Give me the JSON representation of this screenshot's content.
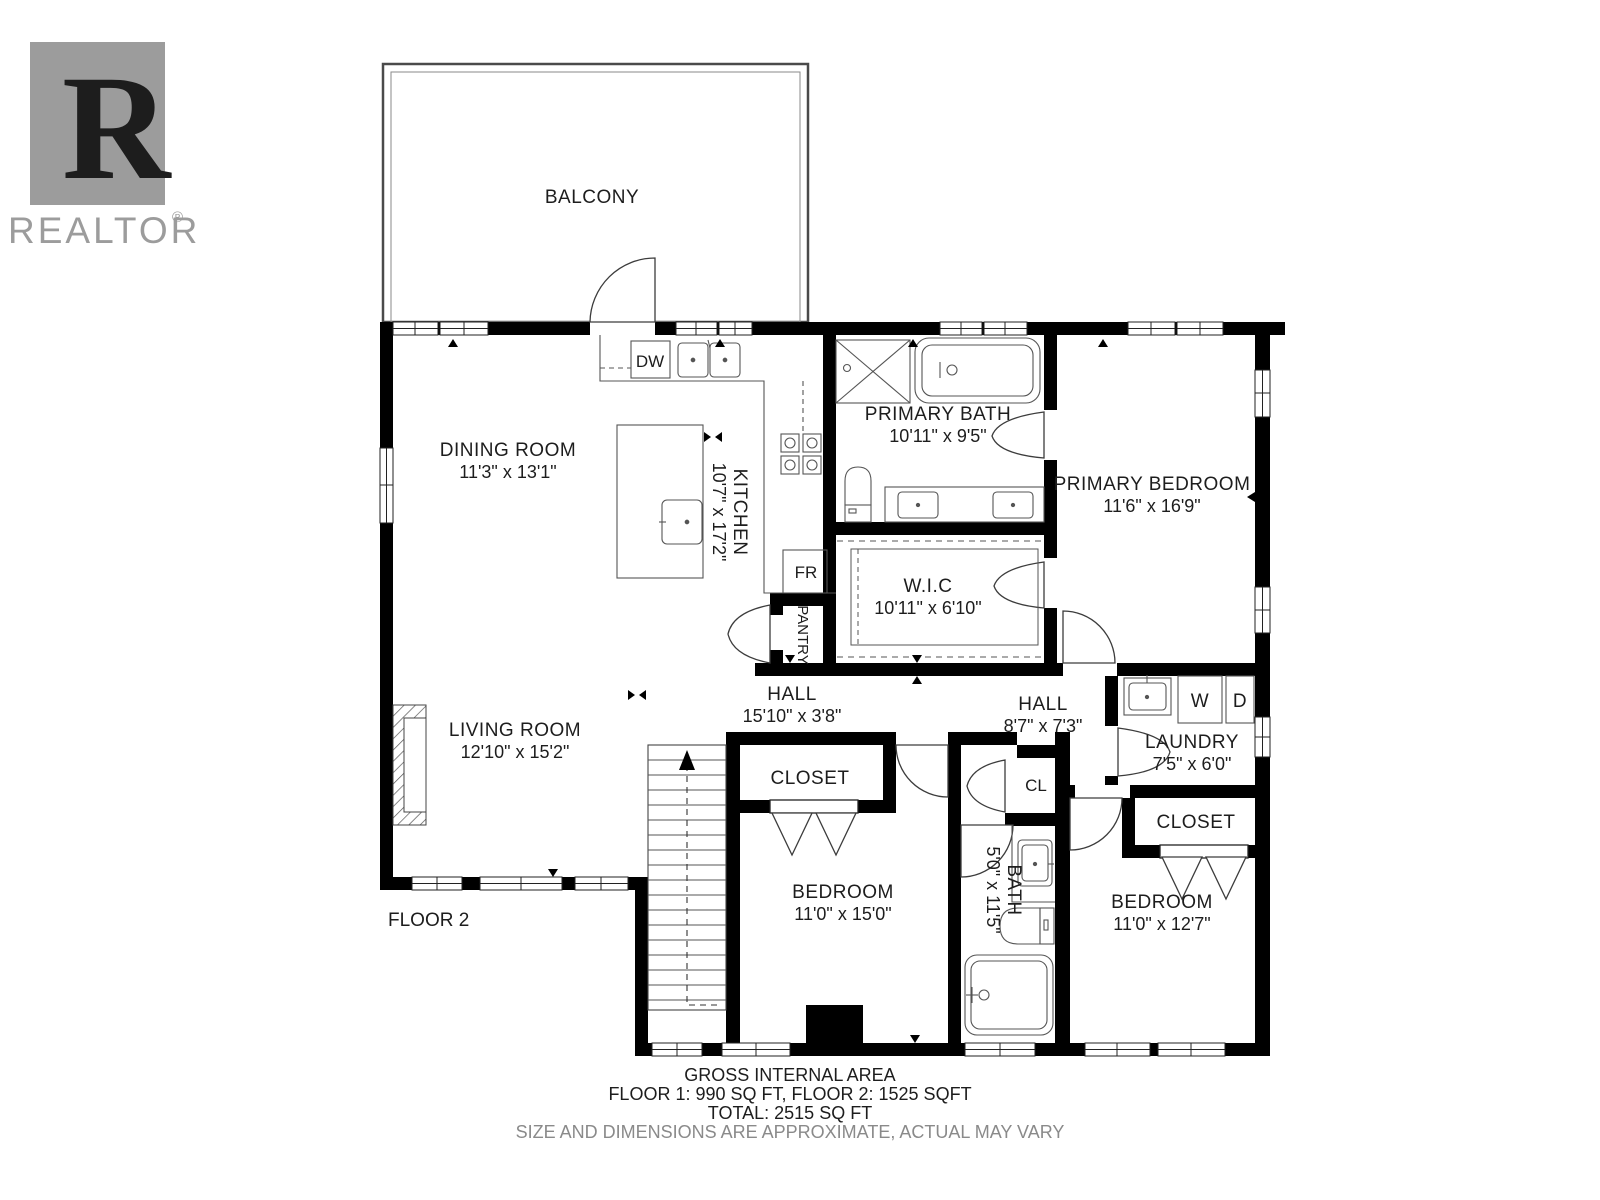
{
  "brand": {
    "logo_letter": "R",
    "logo_text": "REALTOR",
    "registered_mark": "®"
  },
  "floor_label": "FLOOR 2",
  "balcony": {
    "label": "BALCONY"
  },
  "rooms": {
    "dining": {
      "name": "DINING ROOM",
      "dims": "11'3\" x 13'1\""
    },
    "kitchen": {
      "name": "KITCHEN",
      "dims": "10'7\" x 17'2\""
    },
    "primary_bath": {
      "name": "PRIMARY BATH",
      "dims": "10'11\" x 9'5\""
    },
    "primary_bedroom": {
      "name": "PRIMARY BEDROOM",
      "dims": "11'6\" x 16'9\""
    },
    "wic": {
      "name": "W.I.C",
      "dims": "10'11\" x 6'10\""
    },
    "living": {
      "name": "LIVING ROOM",
      "dims": "12'10\" x 15'2\""
    },
    "hall_main": {
      "name": "HALL",
      "dims": "15'10\" x 3'8\""
    },
    "hall_upper": {
      "name": "HALL",
      "dims": "8'7\" x 7'3\""
    },
    "laundry": {
      "name": "LAUNDRY",
      "dims": "7'5\" x 6'0\""
    },
    "closet_bedroom1": {
      "name": "CLOSET"
    },
    "bedroom1": {
      "name": "BEDROOM",
      "dims": "11'0\" x 15'0\""
    },
    "bath2": {
      "name": "BATH",
      "dims": "5'0\" x 11'5\""
    },
    "bedroom2": {
      "name": "BEDROOM",
      "dims": "11'0\" x 12'7\""
    },
    "closet_bedroom2": {
      "name": "CLOSET"
    },
    "closet_hall": {
      "name": "CL"
    },
    "pantry": {
      "name": "PANTRY"
    }
  },
  "appliances": {
    "dishwasher": "DW",
    "fridge": "FR",
    "washer": "W",
    "dryer": "D"
  },
  "footer": {
    "line1": "GROSS INTERNAL AREA",
    "line2": "FLOOR 1: 990 SQ FT, FLOOR 2: 1525 SQFT",
    "line3": "TOTAL: 2515 SQ FT",
    "line4": "SIZE AND DIMENSIONS ARE APPROXIMATE, ACTUAL MAY VARY"
  },
  "colors": {
    "wall": "#000000",
    "line": "#444444",
    "logo_gray": "#9c9c9c",
    "muted": "#8a8a8a"
  }
}
